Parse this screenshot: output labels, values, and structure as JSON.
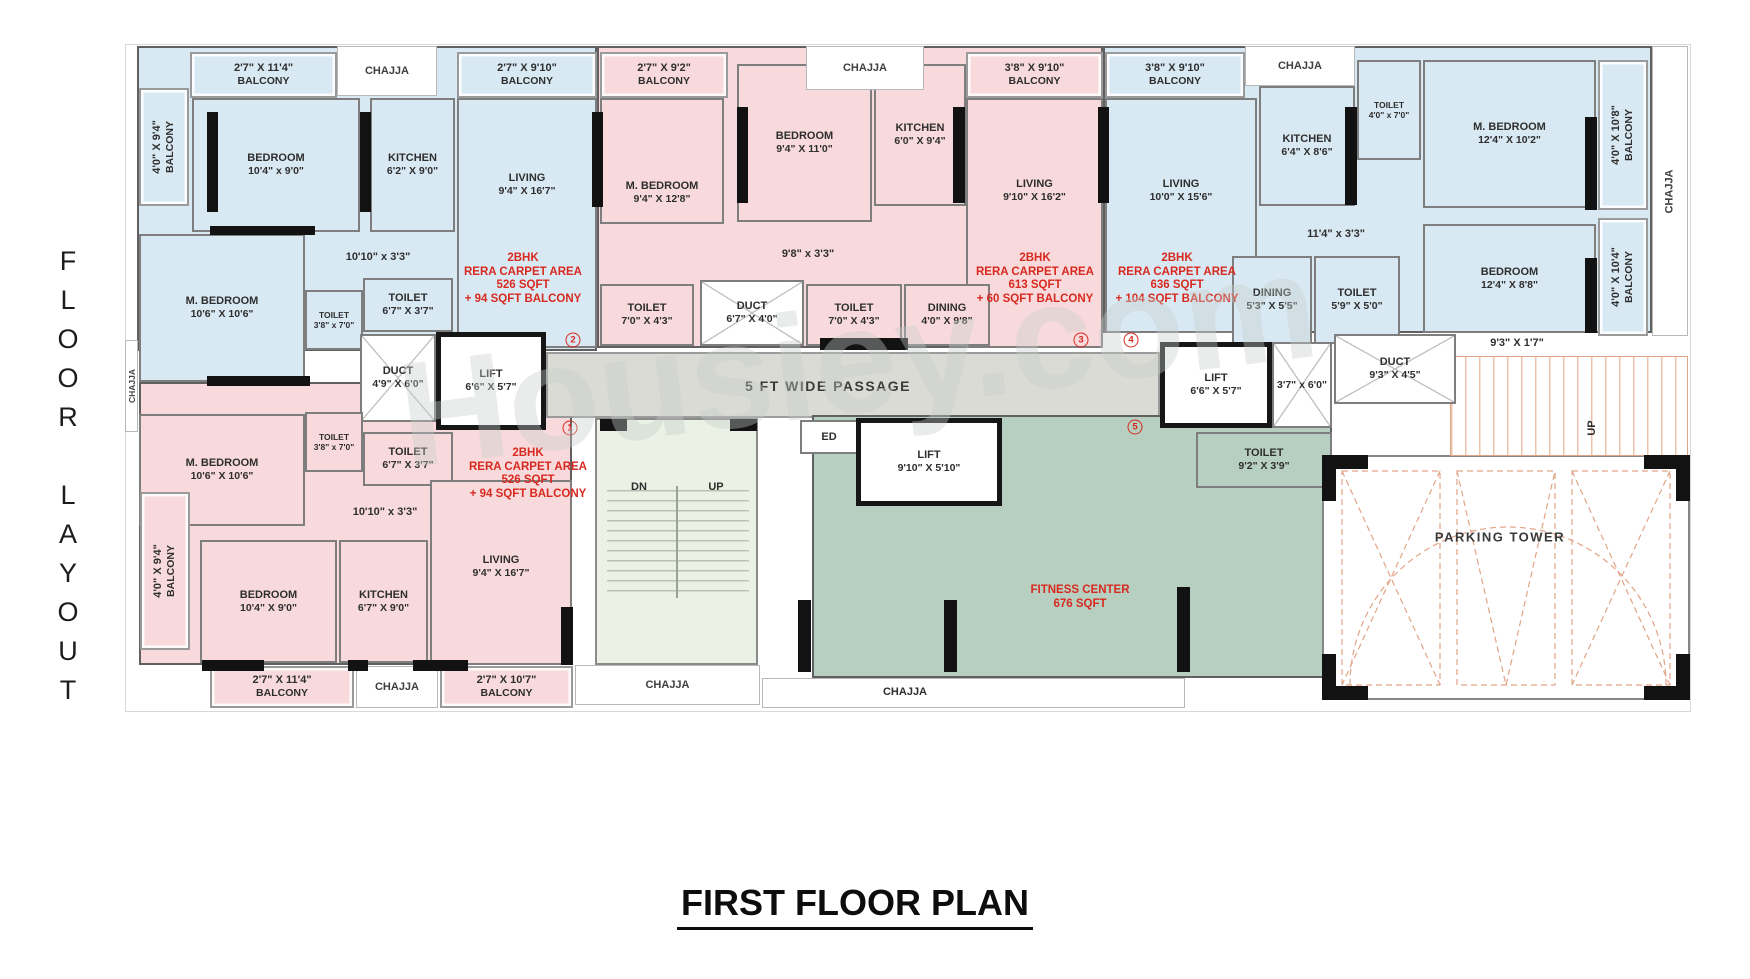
{
  "page": {
    "side_title": "FLOOR LAYOUT",
    "main_title": "FIRST FLOOR PLAN",
    "watermark": "Housiey.com"
  },
  "palette": {
    "blue": "#d9e9f4",
    "pink": "#f8dadc",
    "green": "#b7cfc1",
    "stair": "#ebf1e5",
    "passage": "#dbdbd6",
    "red": "#d8291f"
  },
  "bases": [
    {
      "name": "plan-outline",
      "x": 125,
      "y": 44,
      "w": 1566,
      "h": 668,
      "fill": "none"
    },
    {
      "name": "unit-a",
      "x": 137,
      "y": 46,
      "w": 460,
      "h": 305,
      "fill": "blue"
    },
    {
      "name": "unit-b",
      "x": 597,
      "y": 46,
      "w": 506,
      "h": 302,
      "fill": "pink"
    },
    {
      "name": "unit-c",
      "x": 1103,
      "y": 46,
      "w": 549,
      "h": 287,
      "fill": "blue"
    },
    {
      "name": "unit-1",
      "x": 139,
      "y": 382,
      "w": 433,
      "h": 283,
      "fill": "pink"
    },
    {
      "name": "passage",
      "x": 546,
      "y": 352,
      "w": 614,
      "h": 66,
      "fill": "passage"
    },
    {
      "name": "stairwell",
      "x": 595,
      "y": 418,
      "w": 163,
      "h": 247,
      "fill": "stair"
    },
    {
      "name": "fitness-center",
      "x": 812,
      "y": 415,
      "w": 520,
      "h": 263,
      "fill": "green"
    },
    {
      "name": "parking-tower",
      "x": 1322,
      "y": 455,
      "w": 368,
      "h": 245,
      "fill": "parkwhite"
    },
    {
      "name": "parking-stair",
      "x": 1450,
      "y": 356,
      "w": 238,
      "h": 100,
      "fill": "pstair"
    }
  ],
  "rooms": [
    {
      "name": "balcony-a-top-left",
      "label": "2'7\" X 11'4\"",
      "sub": "BALCONY",
      "x": 190,
      "y": 52,
      "w": 147,
      "h": 46,
      "fill": "blue",
      "balc": 1
    },
    {
      "name": "balcony-a-top-right",
      "label": "2'7\" X 9'10\"",
      "sub": "BALCONY",
      "x": 457,
      "y": 52,
      "w": 140,
      "h": 46,
      "fill": "blue",
      "balc": 1
    },
    {
      "name": "balcony-a-left",
      "label": "4'0\" X 9'4\"",
      "sub": "BALCONY",
      "x": 139,
      "y": 88,
      "w": 50,
      "h": 118,
      "fill": "blue",
      "balc": 1,
      "rot": 1
    },
    {
      "name": "bedroom-a",
      "label": "BEDROOM",
      "sub": "10'4\" x 9'0\"",
      "x": 192,
      "y": 98,
      "w": 168,
      "h": 134,
      "fill": "blue"
    },
    {
      "name": "kitchen-a",
      "label": "KITCHEN",
      "sub": "6'2\" X 9'0\"",
      "x": 370,
      "y": 98,
      "w": 85,
      "h": 134,
      "fill": "blue"
    },
    {
      "name": "living-a",
      "label": "LIVING",
      "sub": "9'4\" X 16'7\"",
      "x": 457,
      "y": 98,
      "w": 140,
      "h": 250,
      "fill": "blue",
      "labelTop": 72
    },
    {
      "name": "mbedroom-a",
      "label": "M. BEDROOM",
      "sub": "10'6\" X 10'6\"",
      "x": 139,
      "y": 234,
      "w": 166,
      "h": 148,
      "fill": "blue"
    },
    {
      "name": "toilet-a-1",
      "label": "TOILET",
      "sub": "3'8\" x 7'0\"",
      "x": 305,
      "y": 290,
      "w": 58,
      "h": 60,
      "fill": "blue",
      "small": 1
    },
    {
      "name": "toilet-a-2",
      "label": "TOILET",
      "sub": "6'7\" X 3'7\"",
      "x": 363,
      "y": 278,
      "w": 90,
      "h": 54,
      "fill": "blue"
    },
    {
      "name": "duct-a",
      "label": "DUCT",
      "sub": "4'9\" X 6'0\"",
      "x": 360,
      "y": 334,
      "w": 76,
      "h": 88,
      "fill": "duct"
    },
    {
      "name": "lift-a",
      "label": "LIFT",
      "sub": "6'6\" X 5'7\"",
      "x": 436,
      "y": 332,
      "w": 110,
      "h": 98,
      "fill": "lift"
    },
    {
      "name": "balcony-b-top",
      "label": "2'7\" X 9'2\"",
      "sub": "BALCONY",
      "x": 600,
      "y": 52,
      "w": 128,
      "h": 46,
      "fill": "pink",
      "balc": 1
    },
    {
      "name": "balcony-b-top-right",
      "label": "3'8\" X 9'10\"",
      "sub": "BALCONY",
      "x": 966,
      "y": 52,
      "w": 137,
      "h": 46,
      "fill": "pink",
      "balc": 1
    },
    {
      "name": "mbedroom-b",
      "label": "M. BEDROOM",
      "sub": "9'4\" X 12'8\"",
      "x": 600,
      "y": 98,
      "w": 124,
      "h": 126,
      "fill": "pink",
      "labelTop": 80
    },
    {
      "name": "bedroom-b",
      "label": "BEDROOM",
      "sub": "9'4\" X 11'0\"",
      "x": 737,
      "y": 64,
      "w": 135,
      "h": 158,
      "fill": "pink"
    },
    {
      "name": "kitchen-b",
      "label": "KITCHEN",
      "sub": "6'0\" X 9'4\"",
      "x": 874,
      "y": 64,
      "w": 92,
      "h": 142,
      "fill": "pink"
    },
    {
      "name": "living-b",
      "label": "LIVING",
      "sub": "9'10\" X 16'2\"",
      "x": 966,
      "y": 98,
      "w": 137,
      "h": 250,
      "fill": "pink",
      "labelTop": 78
    },
    {
      "name": "toilet-b-1",
      "label": "TOILET",
      "sub": "7'0\" X 4'3\"",
      "x": 600,
      "y": 284,
      "w": 94,
      "h": 62,
      "fill": "pink"
    },
    {
      "name": "duct-b",
      "label": "DUCT",
      "sub": "6'7\" X 4'0\"",
      "x": 700,
      "y": 280,
      "w": 104,
      "h": 66,
      "fill": "duct"
    },
    {
      "name": "toilet-b-2",
      "label": "TOILET",
      "sub": "7'0\" X 4'3\"",
      "x": 806,
      "y": 284,
      "w": 96,
      "h": 62,
      "fill": "pink"
    },
    {
      "name": "dining-b",
      "label": "DINING",
      "sub": "4'0\" X 9'8\"",
      "x": 904,
      "y": 284,
      "w": 86,
      "h": 62,
      "fill": "pink"
    },
    {
      "name": "balcony-c-top",
      "label": "3'8\" X 9'10\"",
      "sub": "BALCONY",
      "x": 1105,
      "y": 52,
      "w": 140,
      "h": 46,
      "fill": "blue",
      "balc": 1
    },
    {
      "name": "living-c",
      "label": "LIVING",
      "sub": "10'0\" X 15'6\"",
      "x": 1105,
      "y": 98,
      "w": 152,
      "h": 235,
      "fill": "blue",
      "labelTop": 78
    },
    {
      "name": "kitchen-c",
      "label": "KITCHEN",
      "sub": "6'4\" X 8'6\"",
      "x": 1259,
      "y": 86,
      "w": 96,
      "h": 120,
      "fill": "blue"
    },
    {
      "name": "toilet-c-1",
      "label": "TOILET",
      "sub": "4'0\" x 7'0\"",
      "x": 1357,
      "y": 60,
      "w": 64,
      "h": 100,
      "fill": "blue",
      "small": 1
    },
    {
      "name": "mbedroom-c",
      "label": "M. BEDROOM",
      "sub": "12'4\" X 10'2\"",
      "x": 1423,
      "y": 60,
      "w": 173,
      "h": 148,
      "fill": "blue"
    },
    {
      "name": "dining-c",
      "label": "DINING",
      "sub": "5'3\" X 5'5\"",
      "x": 1232,
      "y": 256,
      "w": 80,
      "h": 88,
      "fill": "blue"
    },
    {
      "name": "toilet-c-2",
      "label": "TOILET",
      "sub": "5'9\" X 5'0\"",
      "x": 1314,
      "y": 256,
      "w": 86,
      "h": 88,
      "fill": "blue"
    },
    {
      "name": "bedroom-c",
      "label": "BEDROOM",
      "sub": "12'4\" X 8'8\"",
      "x": 1423,
      "y": 224,
      "w": 173,
      "h": 109,
      "fill": "blue"
    },
    {
      "name": "balcony-c-right-1",
      "label": "4'0\" X 10'8\"",
      "sub": "BALCONY",
      "x": 1598,
      "y": 60,
      "w": 50,
      "h": 150,
      "fill": "blue",
      "balc": 1,
      "rot": 1
    },
    {
      "name": "balcony-c-right-2",
      "label": "4'0\" X 10'4\"",
      "sub": "BALCONY",
      "x": 1598,
      "y": 218,
      "w": 50,
      "h": 118,
      "fill": "blue",
      "balc": 1,
      "rot": 1
    },
    {
      "name": "lift-right",
      "label": "LIFT",
      "sub": "6'6\" X 5'7\"",
      "x": 1160,
      "y": 342,
      "w": 112,
      "h": 86,
      "fill": "lift"
    },
    {
      "name": "shaft-right",
      "label": "",
      "sub": "3'7\" x 6'0\"",
      "x": 1272,
      "y": 342,
      "w": 60,
      "h": 86,
      "fill": "duct"
    },
    {
      "name": "duct-right",
      "label": "DUCT",
      "sub": "9'3\" X 4'5\"",
      "x": 1334,
      "y": 334,
      "w": 122,
      "h": 70,
      "fill": "duct"
    },
    {
      "name": "mbedroom-1",
      "label": "M. BEDROOM",
      "sub": "10'6\" X 10'6\"",
      "x": 139,
      "y": 414,
      "w": 166,
      "h": 112,
      "fill": "pink"
    },
    {
      "name": "toilet-1-1",
      "label": "TOILET",
      "sub": "3'8\" x 7'0\"",
      "x": 305,
      "y": 412,
      "w": 58,
      "h": 60,
      "fill": "pink",
      "small": 1
    },
    {
      "name": "toilet-1-2",
      "label": "TOILET",
      "sub": "6'7\" X 3'7\"",
      "x": 363,
      "y": 432,
      "w": 90,
      "h": 54,
      "fill": "pink"
    },
    {
      "name": "living-1",
      "label": "LIVING",
      "sub": "9'4\" X 16'7\"",
      "x": 430,
      "y": 480,
      "w": 142,
      "h": 185,
      "fill": "pink",
      "labelTop": 72
    },
    {
      "name": "bedroom-1",
      "label": "BEDROOM",
      "sub": "10'4\" X 9'0\"",
      "x": 200,
      "y": 540,
      "w": 137,
      "h": 123,
      "fill": "pink"
    },
    {
      "name": "kitchen-1",
      "label": "KITCHEN",
      "sub": "6'7\" X 9'0\"",
      "x": 339,
      "y": 540,
      "w": 89,
      "h": 123,
      "fill": "pink"
    },
    {
      "name": "balcony-1-left",
      "label": "4'0\" X 9'4\"",
      "sub": "BALCONY",
      "x": 140,
      "y": 492,
      "w": 50,
      "h": 158,
      "fill": "pink",
      "balc": 1,
      "rot": 1
    },
    {
      "name": "balcony-1-bottom-1",
      "label": "2'7\" X 11'4\"",
      "sub": "BALCONY",
      "x": 210,
      "y": 666,
      "w": 144,
      "h": 42,
      "fill": "pink",
      "balc": 1
    },
    {
      "name": "balcony-1-bottom-2",
      "label": "2'7\" X 10'7\"",
      "sub": "BALCONY",
      "x": 440,
      "y": 666,
      "w": 133,
      "h": 42,
      "fill": "pink",
      "balc": 1
    },
    {
      "name": "ed-lobby",
      "label": "ED",
      "sub": "",
      "x": 800,
      "y": 420,
      "w": 58,
      "h": 34,
      "fill": "white"
    },
    {
      "name": "lift-center",
      "label": "LIFT",
      "sub": "9'10\" X 5'10\"",
      "x": 856,
      "y": 418,
      "w": 146,
      "h": 88,
      "fill": "lift"
    },
    {
      "name": "toilet-fitness",
      "label": "TOILET",
      "sub": "9'2\" X 3'9\"",
      "x": 1196,
      "y": 432,
      "w": 136,
      "h": 56,
      "fill": "green"
    },
    {
      "name": "chajja-top-1",
      "label": "CHAJJA",
      "sub": "",
      "x": 337,
      "y": 46,
      "w": 100,
      "h": 50,
      "fill": "chajja"
    },
    {
      "name": "chajja-top-2",
      "label": "CHAJJA",
      "sub": "",
      "x": 806,
      "y": 46,
      "w": 118,
      "h": 44,
      "fill": "chajja"
    },
    {
      "name": "chajja-top-3",
      "label": "CHAJJA",
      "sub": "",
      "x": 1245,
      "y": 46,
      "w": 110,
      "h": 40,
      "fill": "chajja"
    },
    {
      "name": "chajja-right",
      "label": "CHAJJA",
      "sub": "",
      "x": 1652,
      "y": 46,
      "w": 36,
      "h": 290,
      "fill": "chajja",
      "rot": 1
    },
    {
      "name": "chajja-left",
      "label": "CHAJJA",
      "sub": "",
      "x": 125,
      "y": 340,
      "w": 13,
      "h": 92,
      "fill": "chajja",
      "rot": 1,
      "small": 1
    },
    {
      "name": "chajja-bottom-1",
      "label": "CHAJJA",
      "sub": "",
      "x": 356,
      "y": 666,
      "w": 82,
      "h": 42,
      "fill": "chajja"
    },
    {
      "name": "chajja-bottom-2",
      "label": "CHAJJA",
      "sub": "",
      "x": 575,
      "y": 665,
      "w": 185,
      "h": 40,
      "fill": "chajja"
    },
    {
      "name": "chajja-bottom-3",
      "label": "",
      "sub": "",
      "x": 762,
      "y": 678,
      "w": 423,
      "h": 30,
      "fill": "chajja"
    }
  ],
  "free_labels": [
    {
      "text": "10'10\" x 3'3\"",
      "x": 378,
      "y": 257
    },
    {
      "text": "9'8\" x 3'3\"",
      "x": 808,
      "y": 254
    },
    {
      "text": "11'4\" x 3'3\"",
      "x": 1336,
      "y": 234
    },
    {
      "text": "10'10\" x 3'3\"",
      "x": 385,
      "y": 512
    },
    {
      "text": "9'3\" X 1'7\"",
      "x": 1517,
      "y": 343
    },
    {
      "text": "5 FT WIDE PASSAGE",
      "x": 828,
      "y": 386,
      "size": 14,
      "spaced": 1
    },
    {
      "text": "DN",
      "x": 639,
      "y": 487
    },
    {
      "text": "UP",
      "x": 716,
      "y": 487
    },
    {
      "text": "UP",
      "x": 1592,
      "y": 428,
      "rot": 1
    },
    {
      "text": "PARKING TOWER",
      "x": 1500,
      "y": 537,
      "size": 13,
      "spaced": 1
    },
    {
      "text": "CHAJJA",
      "x": 905,
      "y": 692
    }
  ],
  "red_blocks": [
    {
      "x": 523,
      "y": 252,
      "lines": [
        "2BHK",
        "RERA CARPET AREA",
        "526 SQFT",
        "+ 94 SQFT BALCONY"
      ]
    },
    {
      "x": 1035,
      "y": 252,
      "lines": [
        "2BHK",
        "RERA CARPET AREA",
        "613 SQFT",
        "+ 60 SQFT BALCONY"
      ]
    },
    {
      "x": 1177,
      "y": 252,
      "lines": [
        "2BHK",
        "RERA CARPET AREA",
        "636 SQFT",
        "+ 104 SQFT BALCONY"
      ]
    },
    {
      "x": 528,
      "y": 447,
      "lines": [
        "2BHK",
        "RERA CARPET AREA",
        "526 SQFT",
        "+ 94 SQFT BALCONY"
      ]
    },
    {
      "x": 1080,
      "y": 584,
      "lines": [
        "FITNESS CENTER",
        "676 SQFT"
      ]
    }
  ],
  "markers": [
    {
      "n": "1",
      "x": 570,
      "y": 428
    },
    {
      "n": "2",
      "x": 573,
      "y": 340
    },
    {
      "n": "3",
      "x": 1081,
      "y": 340
    },
    {
      "n": "4",
      "x": 1131,
      "y": 340
    },
    {
      "n": "5",
      "x": 1135,
      "y": 427
    }
  ],
  "black_bars": [
    [
      207,
      112,
      11,
      100
    ],
    [
      360,
      112,
      11,
      100
    ],
    [
      592,
      112,
      11,
      95
    ],
    [
      737,
      107,
      11,
      96
    ],
    [
      953,
      107,
      12,
      96
    ],
    [
      1098,
      107,
      11,
      96
    ],
    [
      1345,
      107,
      12,
      98
    ],
    [
      1585,
      117,
      12,
      93
    ],
    [
      1585,
      258,
      12,
      75
    ],
    [
      820,
      338,
      88,
      12
    ],
    [
      600,
      419,
      27,
      12
    ],
    [
      730,
      419,
      27,
      12
    ],
    [
      798,
      600,
      13,
      72
    ],
    [
      944,
      600,
      13,
      72
    ],
    [
      1177,
      587,
      13,
      85
    ],
    [
      561,
      607,
      12,
      58
    ],
    [
      202,
      660,
      62,
      11
    ],
    [
      348,
      660,
      20,
      11
    ],
    [
      413,
      660,
      55,
      11
    ],
    [
      210,
      226,
      105,
      9
    ],
    [
      207,
      376,
      103,
      10
    ],
    [
      1322,
      455,
      46,
      14
    ],
    [
      1322,
      455,
      14,
      46
    ],
    [
      1644,
      455,
      46,
      14
    ],
    [
      1676,
      455,
      14,
      46
    ],
    [
      1322,
      654,
      14,
      46
    ],
    [
      1322,
      686,
      46,
      14
    ],
    [
      1676,
      654,
      14,
      46
    ],
    [
      1644,
      686,
      46,
      14
    ]
  ],
  "stair": {
    "treads": [
      607,
      490,
      142,
      102
    ],
    "rail": [
      676,
      486,
      2,
      112
    ]
  }
}
